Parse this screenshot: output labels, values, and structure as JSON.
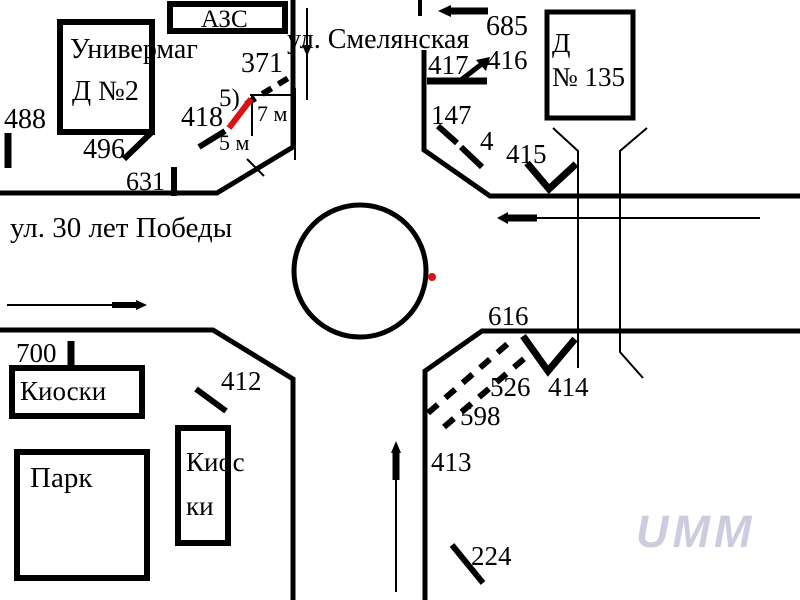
{
  "scene": "traffic-intersection-scheme-with-roundabout",
  "streets": {
    "top": "ул. Смелянская",
    "left": "ул. 30 лет Победы"
  },
  "buildings": {
    "univermag_line1": "Универмаг",
    "univermag_line2": "Д №2",
    "azs": "АЗС",
    "house135_line1": "Д",
    "house135_line2": "№ 135",
    "kiosks": "Киоски",
    "park": "Парк",
    "kiosk2_line1": "Киос",
    "kiosk2_line2": "ки"
  },
  "labels": {
    "n488": "488",
    "n496": "496",
    "n631": "631",
    "n371": "371",
    "n418": "418",
    "n685": "685",
    "n417": "417",
    "n416": "416",
    "n147": "147",
    "n4": "4",
    "n415": "415",
    "n616": "616",
    "n526": "526",
    "n414": "414",
    "n598": "598",
    "n413": "413",
    "n224": "224",
    "n700": "700",
    "n412": "412"
  },
  "measurements": {
    "note5": "5)",
    "dist7m": "7 м",
    "dist5m": "5 м"
  },
  "watermark": "UMM",
  "colors": {
    "ink": "#000000",
    "red": "#dd1111",
    "watermark": "#ccccdf"
  }
}
